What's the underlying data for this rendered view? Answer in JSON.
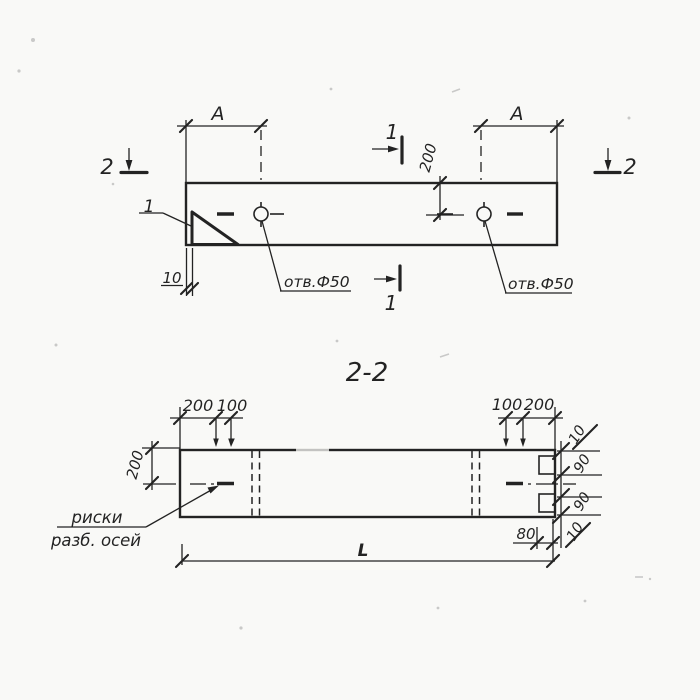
{
  "colors": {
    "ink": "#232323",
    "paper": "#f9f9f7"
  },
  "plan": {
    "dim_a_left": "A",
    "dim_a_right": "A",
    "dim_200": "200",
    "dim_10": "10",
    "hole_note_left": "отв.Ф50",
    "hole_note_right": "отв.Ф50",
    "detail_mark": "1",
    "section_mark_1_top": "1",
    "section_mark_1_bottom": "1",
    "section_mark_2_left": "2",
    "section_mark_2_right": "2"
  },
  "section": {
    "title": "2-2",
    "dims_top_left": [
      "200",
      "100"
    ],
    "dims_top_right": [
      "100",
      "200"
    ],
    "dim_height": "200",
    "right_chain": [
      "10",
      "90",
      "90",
      "10"
    ],
    "dim_80": "80",
    "dim_length": "L",
    "note_line1": "риски",
    "note_line2": "разб. осей"
  }
}
